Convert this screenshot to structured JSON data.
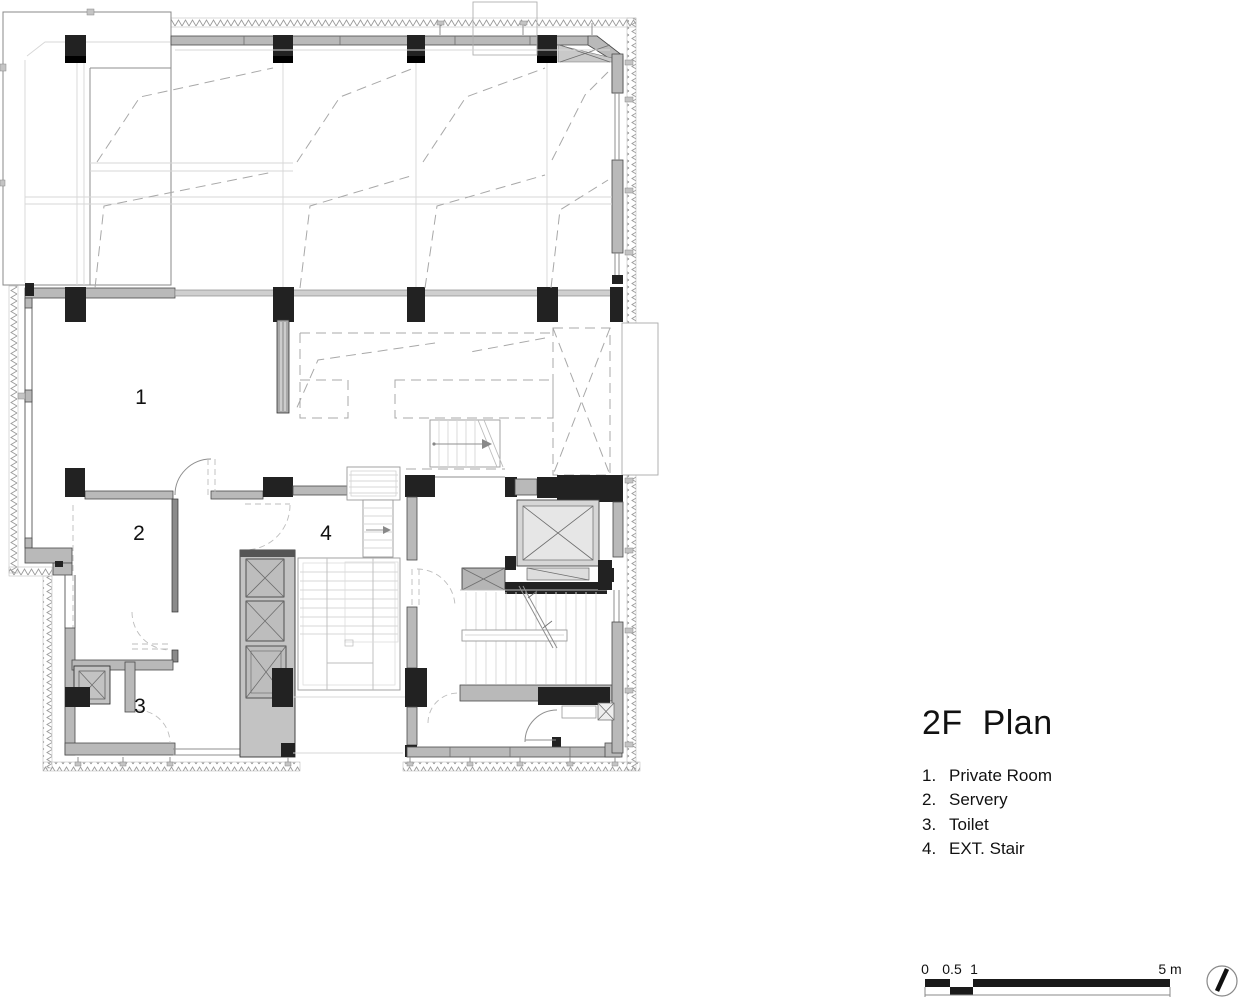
{
  "title": "2F  Plan",
  "legend": {
    "items": [
      {
        "num": "1.",
        "label": "Private Room"
      },
      {
        "num": "2.",
        "label": "Servery"
      },
      {
        "num": "3.",
        "label": "Toilet"
      },
      {
        "num": "4.",
        "label": "EXT. Stair"
      }
    ]
  },
  "plan": {
    "room_labels": [
      {
        "number": "1",
        "name": "Private Room"
      },
      {
        "number": "2",
        "name": "Servery"
      },
      {
        "number": "3",
        "name": "Toilet"
      },
      {
        "number": "4",
        "name": "EXT. Stair"
      }
    ]
  },
  "scale_bar": {
    "tick0": "0",
    "tick05": "0.5",
    "tick1": "1",
    "tick5": "5 m"
  },
  "icons": {
    "north": "north-needle-icon"
  },
  "colors": {
    "wall_fill": "#b9b9b9",
    "column_fill": "#222222",
    "dash_line": "#a8a8a8",
    "scale_fill": "#1a1a1a",
    "line_light": "#d7d7d7"
  }
}
